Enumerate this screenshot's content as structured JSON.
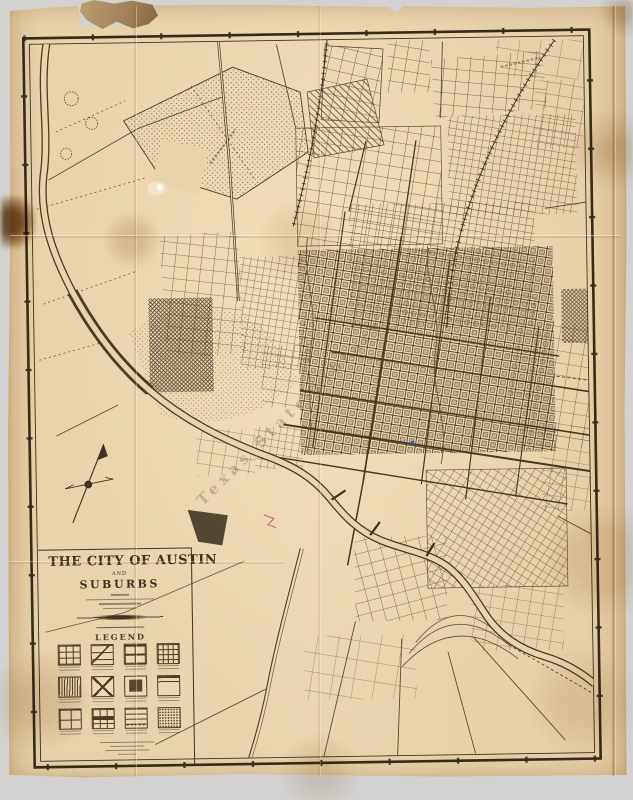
{
  "scene": {
    "background_color": "#d3d2d0",
    "paper_color": "#e7d2aa",
    "ink_color": "#3e3322",
    "frame_color": "#352b1b",
    "description": "Aged folded paper map scan with torn top edge, stains and fold creases"
  },
  "map": {
    "title_line1": "THE CITY OF AUSTIN",
    "title_and": "AND",
    "title_line2": "SUBURBS",
    "title_small_bar_widths": [
      18,
      68,
      42,
      34
    ],
    "legend_title": "LEGEND",
    "watermark": "Texas State Library",
    "publisher_bar_widths": [
      54,
      34,
      44,
      18
    ],
    "legend_items": [
      {
        "pattern": "grid-streets"
      },
      {
        "pattern": "diagonal-corner"
      },
      {
        "pattern": "banded-grid"
      },
      {
        "pattern": "inner-grid"
      },
      {
        "pattern": "vertical-hatch"
      },
      {
        "pattern": "cross-diagonal"
      },
      {
        "pattern": "solid-block"
      },
      {
        "pattern": "top-bands"
      },
      {
        "pattern": "open-grid"
      },
      {
        "pattern": "grid-band"
      },
      {
        "pattern": "lined-dotted"
      },
      {
        "pattern": "stipple"
      }
    ],
    "features": {
      "river": "Colorado River winding band from top-left through centre to bottom-right",
      "compass": "north-arrow cross at left centre",
      "city_grid": "dense rotated street grid centre-right with outlying additions",
      "marks": [
        "small blue dot in grid",
        "small red scribble near river",
        "dark solid pond south-west of downtown"
      ]
    }
  }
}
